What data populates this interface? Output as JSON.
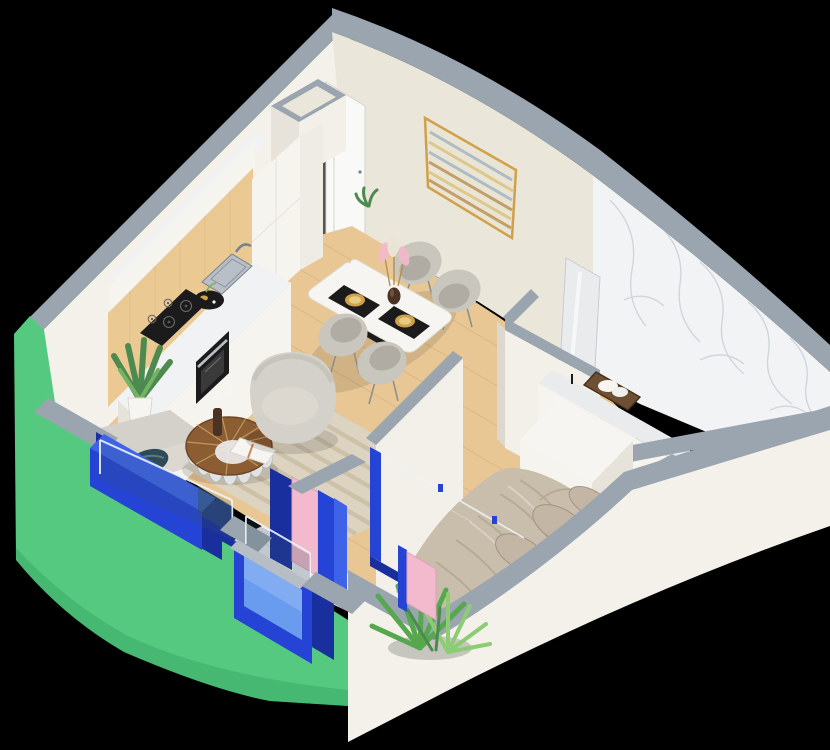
{
  "title": "Isometric 3D floor plan render — one-bedroom apartment",
  "canvas": {
    "width": 830,
    "height": 750
  },
  "scene": {
    "view": "axonometric cutaway (dollhouse) render on black background",
    "rooms": [
      {
        "name": "kitchen"
      },
      {
        "name": "living-dining"
      },
      {
        "name": "hallway"
      },
      {
        "name": "bathroom"
      },
      {
        "name": "bedroom"
      },
      {
        "name": "balcony"
      }
    ],
    "furniture": [
      "kitchen-cabinets",
      "cooktop",
      "oven",
      "sink",
      "prep-tray",
      "dining-table",
      "dining-chairs",
      "wall-art",
      "armchair",
      "sofa",
      "coffee-table",
      "rug",
      "potted-plant",
      "entry-door",
      "bed",
      "dresser",
      "vanity-basin",
      "towel-basket",
      "mirror",
      "palm-plant",
      "duct-shaft"
    ]
  },
  "palette": {
    "bg": "#000000",
    "capGray": "#9aa5af",
    "capGrayLight": "#b6bdc5",
    "creamNW": "#f3f1ea",
    "creamNE": "#ebe6da",
    "whiteFace": "#f2f0e9",
    "edgeLight": "#dcd8ce",
    "doorWhite": "#f9f9f7",
    "doorEdge": "#d6d4ce",
    "doorGap": "#56524a",
    "wood": "#e9c795",
    "plank": "#d2ad77",
    "panelWood": "#ebc993",
    "counter": "#f1f2f4",
    "cabFront": "#f6f4ef",
    "cabShade": "#e7e3da",
    "cabSide": "#eeece5",
    "black": "#1b1b1b",
    "graphite": "#3a3a3a",
    "steel": "#b9bfc7",
    "steelDark": "#79828c",
    "marble": "#f2f3f5",
    "vein": "#c6ccd5",
    "marbleFloor": "#e9ebed",
    "green": "#55c980",
    "greenDark": "#3aa862",
    "royal": "#2544d6",
    "royalDark": "#1a2f9e",
    "royalMid": "#3f63e8",
    "sky": "#699bee",
    "skyLight": "#92b7f4",
    "pink": "#f3b9cc",
    "pinkShade": "#e2a0b7",
    "glass": "#eef3f7",
    "glassTint": "#32525e",
    "teal": "#2e4b58",
    "rug": "#dcd4c1",
    "rugStripe": "#c6ba9f",
    "sofa": "#d4d1ca",
    "sofaShade": "#b7b3aa",
    "seat": "#dcd8cf",
    "chair": "#c9c6be",
    "chairIn": "#b0aca3",
    "leg": "#8f8f8d",
    "linen": "#c9bdac",
    "linenDeep": "#a2947f",
    "pillowTan": "#c3b6a4",
    "tableWood": "#8c5c33",
    "tableWoodDark": "#6f4726",
    "scallop": "#e0e2e4",
    "plant": "#4c8a4f",
    "plantLight": "#74b364",
    "palm": "#57a74e",
    "palmLight": "#8ccd74",
    "gold": "#cfa14b",
    "goldLight": "#e7cb83",
    "artBase": "#eae4d4",
    "artYellow": "#d9c27c",
    "artBlue": "#9fb4c2",
    "artBrown": "#b98f4e",
    "basket": "#6d4f33",
    "basketDark": "#452f18",
    "bottle": "#4a3324",
    "white": "#f6f5f2"
  }
}
